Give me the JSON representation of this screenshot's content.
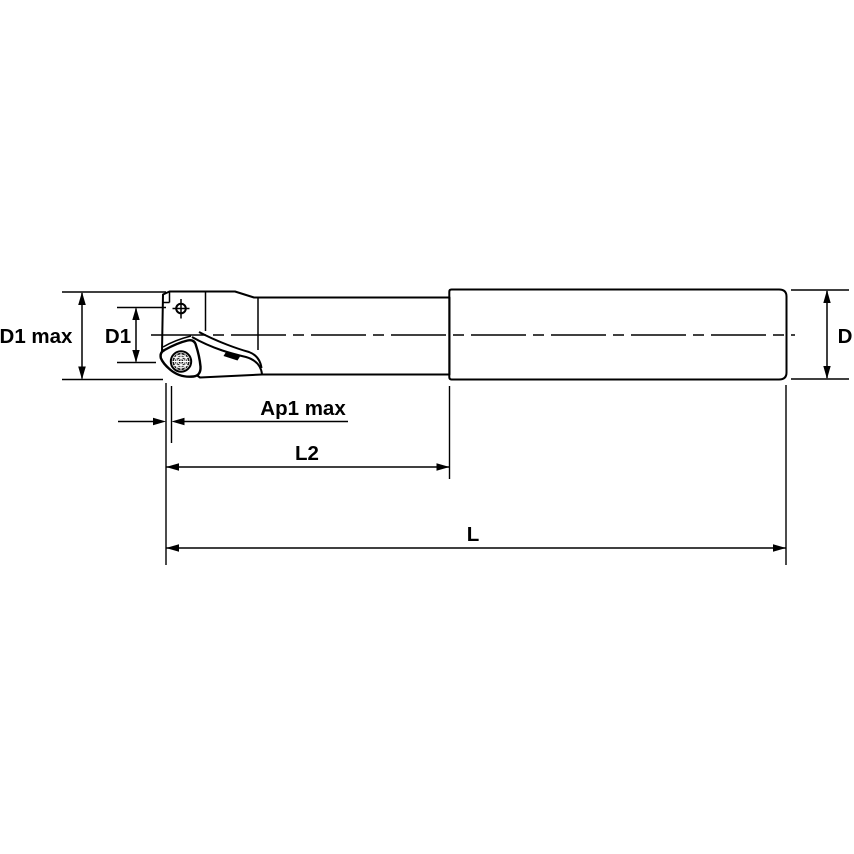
{
  "drawing": {
    "labels": {
      "d1_max": "D1 max",
      "d1": "D1",
      "d": "D",
      "ap1_max": "Ap1 max",
      "l2": "L2",
      "l": "L"
    },
    "colors": {
      "body_fill": "#d5d5d5",
      "insert_fill": "#ffffff",
      "screw_fill": "#181818",
      "line": "#000000",
      "background": "#ffffff"
    }
  }
}
